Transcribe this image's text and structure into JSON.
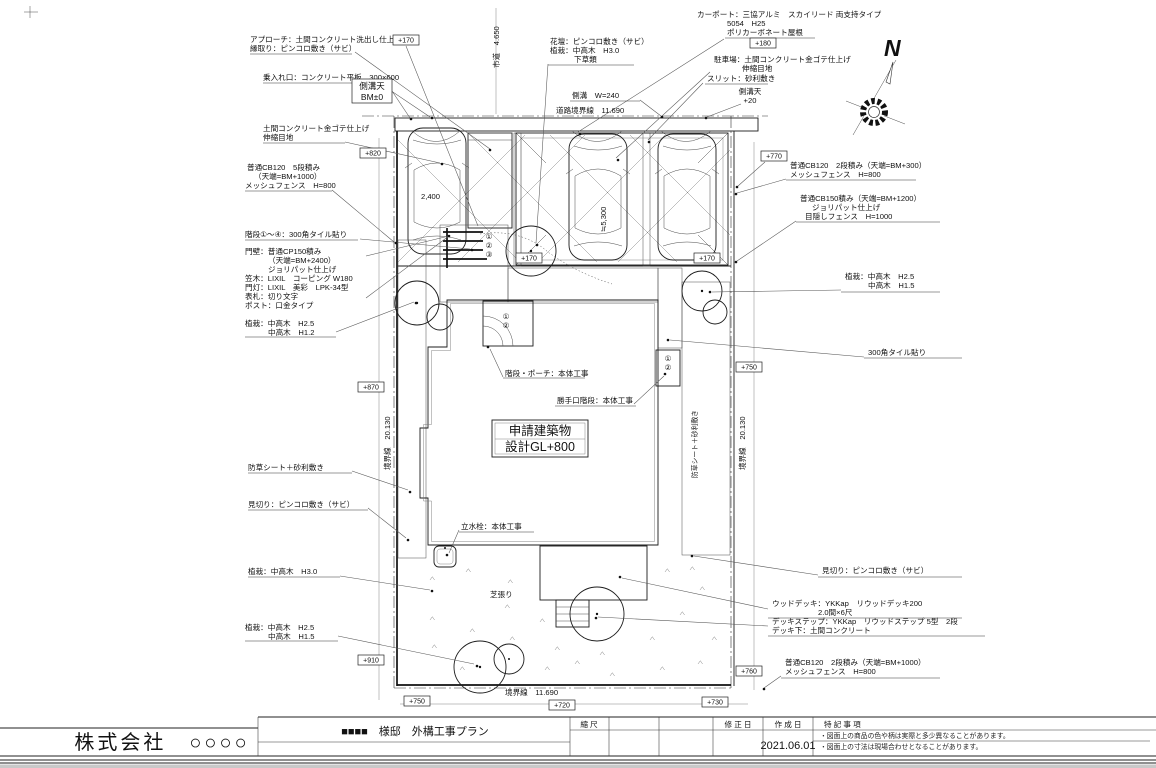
{
  "title_block": {
    "company": "株式会社　○○○○",
    "drawing_title": "■■■■　様邸　外構工事プラン",
    "scale_label": "縮 尺",
    "revision_label": "修 正 日",
    "created_label": "作 成 日",
    "notes_label": "特 記 事 項",
    "created_date": "2021.06.01",
    "note1": "・図面上の商品の色や柄は実際と多少異なることがあります。",
    "note2": "・図面上の寸法は現場合わせとなることがあります。"
  },
  "compass": {
    "north": "N"
  },
  "boundaries": {
    "road": "道路境界線　11.690",
    "left": "境界線　20.130",
    "right": "境界線　20.130",
    "bottom": "境界線　11.690",
    "road_width": "市道　4.650"
  },
  "dimensions": {
    "car_width": "2,400",
    "parking_depth": "≒5,300",
    "gutter": "側溝　W=240"
  },
  "levels": {
    "bm_label": "側溝天",
    "bm_val": "BM±0",
    "gt_label": "側溝天",
    "gt_val": "+20",
    "p170a": "+170",
    "p170b": "+170",
    "p170c": "+170",
    "p180": "+180",
    "p820": "+820",
    "p870": "+870",
    "p910": "+910",
    "p770": "+770",
    "p750r": "+750",
    "p760": "+760",
    "p750b": "+750",
    "p720": "+720",
    "p730": "+730"
  },
  "building": {
    "line1": "申請建築物",
    "line2": "設計GL+800"
  },
  "steps": {
    "s1": "①",
    "s2": "②",
    "s3": "③",
    "p1": "①",
    "p2": "②",
    "k1": "①",
    "k2": "②"
  },
  "labels": {
    "approach1": "アプローチ：土間コンクリート洗出し仕上げ",
    "approach2": "縁取り：ピンコロ敷き（サビ）",
    "entry": "乗入れ口：コンクリート平板　300×600",
    "slab1": "土間コンクリート金ゴテ仕上げ",
    "slab2": "伸縮目地",
    "cb5a": "普通CB120　5段積み",
    "cb5b": "（天端=BM+1000）",
    "cb5c": "メッシュフェンス　H=800",
    "stairs": "階段①～④：300角タイル貼り",
    "gate1": "門壁：普通CP150積み",
    "gate2": "（天端=BM+2400）",
    "gate3": "ジョリパット仕上げ",
    "gate4": "笠木：LIXIL　コーピング W180",
    "gate5": "門灯：LIXIL　美彩　LPK-34型",
    "gate6": "表札：切り文字",
    "gate7": "ポスト：口金タイプ",
    "plant_l1a": "植栽：中高木　H2.5",
    "plant_l1b": "中高木　H1.2",
    "weed": "防草シート＋砂利敷き",
    "edge": "見切り：ピンコロ敷き（サビ）",
    "plant_l2": "植栽：中高木　H3.0",
    "plant_l3a": "植栽：中高木　H2.5",
    "plant_l3b": "中高木　H1.5",
    "flower1": "花壇：ピンコロ敷き（サビ）",
    "flower2": "植栽：中高木　H3.0",
    "flower3": "下草類",
    "carport1": "カーポート：三協アルミ　スカイリード 両支持タイプ",
    "carport2": "5054　H25",
    "carport3": "ポリカーボネート屋根",
    "parking1": "駐車場：土間コンクリート金ゴテ仕上げ",
    "parking2": "伸縮目地",
    "slit": "スリット：砂利敷き",
    "cb2r_a": "普通CB120　2段積み（天端=BM+300）",
    "cb2r_b": "メッシュフェンス　H=800",
    "cb150a": "普通CB150積み（天端=BM+1200）",
    "cb150b": "ジョリパット仕上げ",
    "cb150c": "目隠しフェンス　H=1000",
    "plant_r1a": "植栽：中高木　H2.5",
    "plant_r1b": "中高木　H1.5",
    "tile300": "300角タイル貼り",
    "edge2": "見切り：ピンコロ敷き（サビ）",
    "deck1": "ウッドデッキ：YKKap　リウッドデッキ200",
    "deck2": "2.0間×6尺",
    "deck3": "デッキステップ：YKKap　リウッドステップ 5型　2段",
    "deck4": "デッキ下：土間コンクリート",
    "cb2b_a": "普通CB120　2段積み（天端=BM+1000）",
    "cb2b_b": "メッシュフェンス　H=800",
    "porch": "階段・ポーチ：本体工事",
    "kitchen": "勝手口階段：本体工事",
    "faucet": "立水栓：本体工事",
    "lawn": "芝張り",
    "weed_v": "防草シート＋砂利敷き"
  }
}
